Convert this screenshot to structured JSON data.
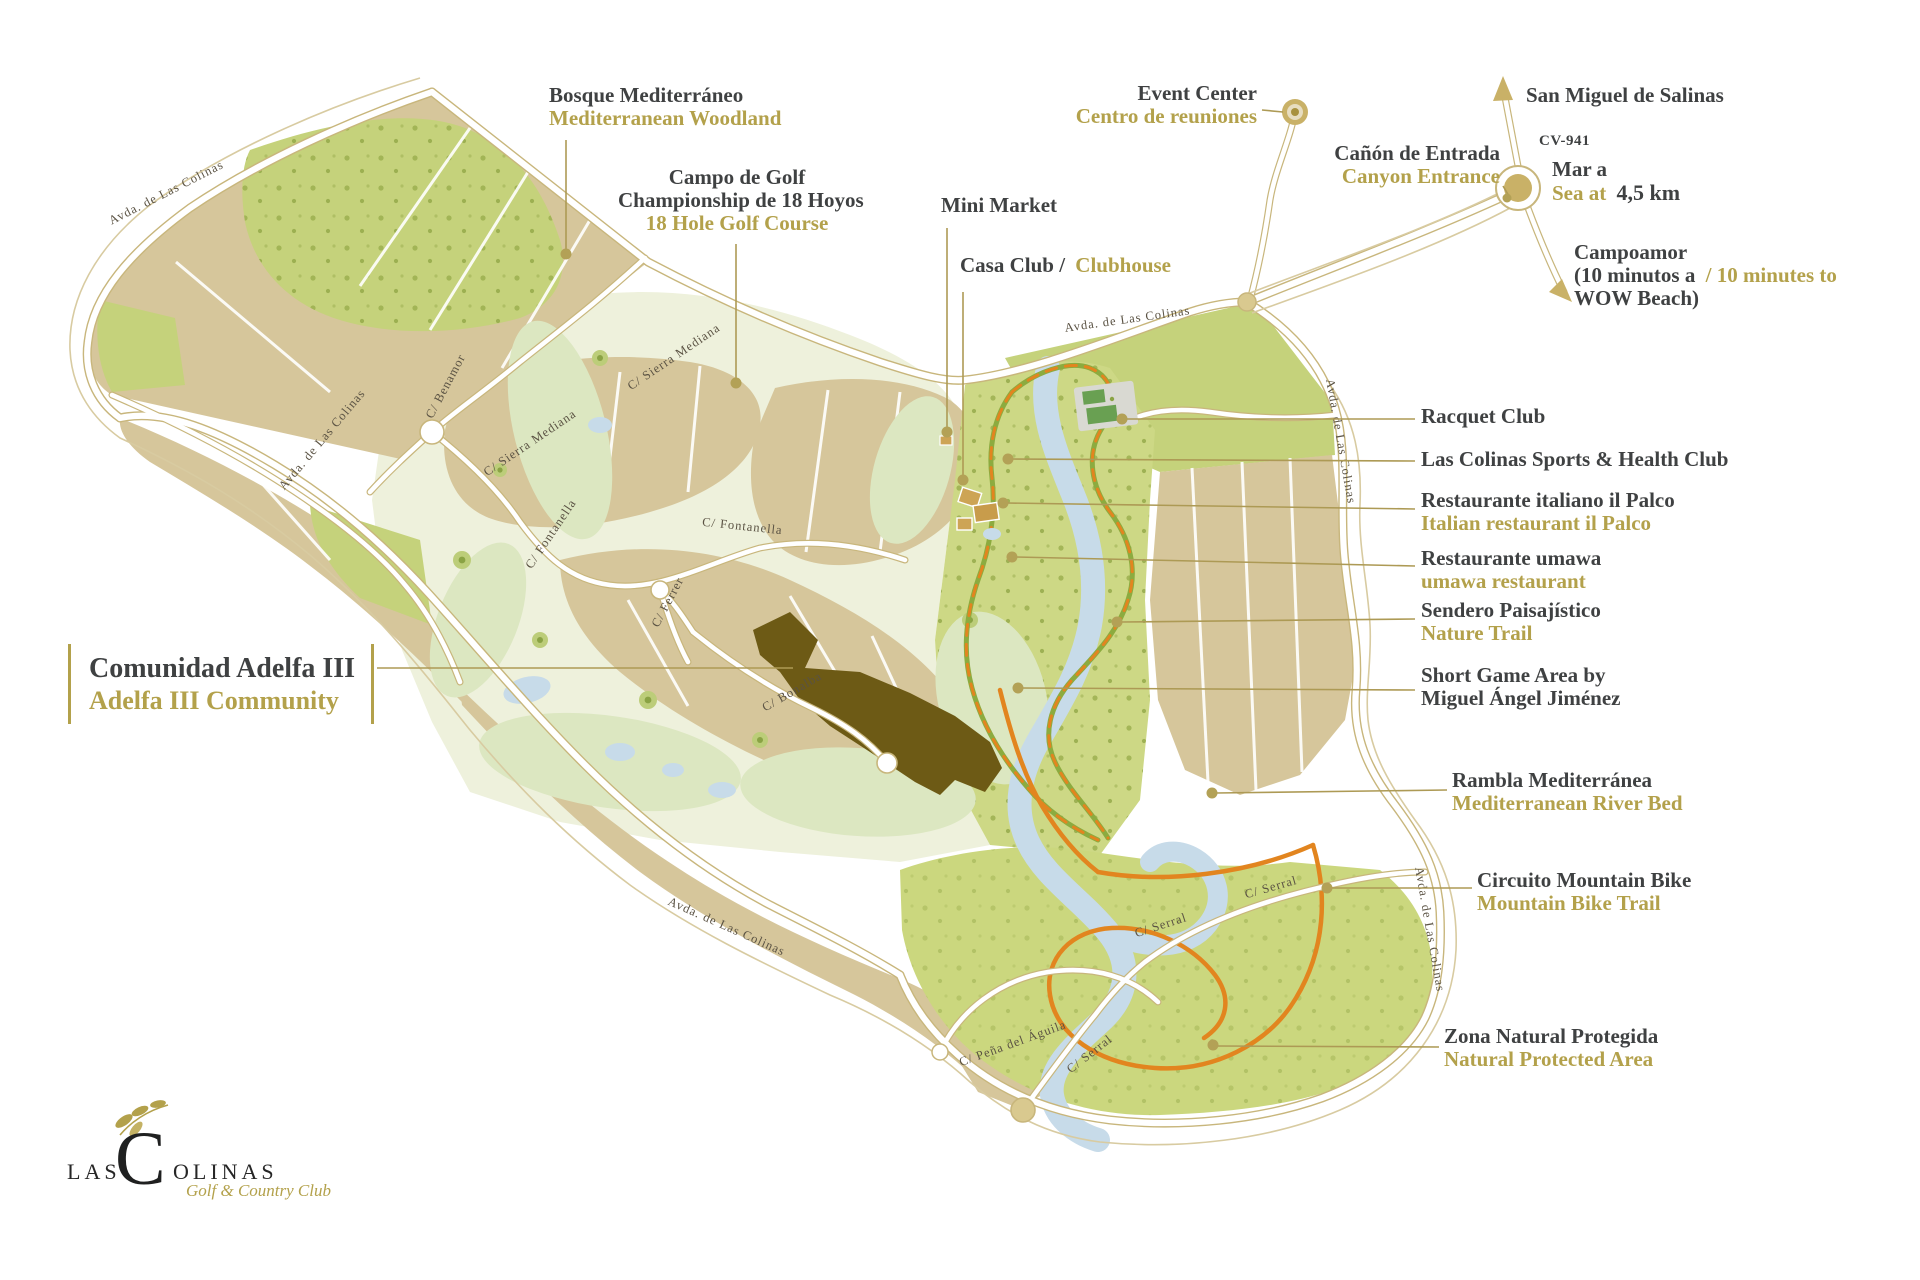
{
  "colors": {
    "ink": "#3f4142",
    "gold_text": "#b3a14b",
    "road_gold": "#c8b67c",
    "parcel_tan": "#d6c69b",
    "parcel_green": "#c5d27b",
    "corridor_green": "#cdd885",
    "golf_pale": "#eef1dc",
    "river_blue": "#c7dbe9",
    "trail_orange": "#e2851f",
    "trail_green": "#8cab3f",
    "adelfa_brown": "#6d5a15"
  },
  "logo": {
    "prefix": "LAS",
    "initial": "C",
    "suffix": "OLINAS",
    "tagline": "Golf & Country Club",
    "branch_icon": "olive-branch"
  },
  "featured": {
    "primary": "Comunidad Adelfa III",
    "secondary": "Adelfa III Community"
  },
  "callouts": {
    "bosque": {
      "primary": "Bosque Mediterráneo",
      "secondary": "Mediterranean Woodland"
    },
    "campo": {
      "line1": "Campo de Golf",
      "line2": "Championship de 18 Hoyos",
      "secondary": "18 Hole Golf Course"
    },
    "mini_market": {
      "primary": "Mini Market"
    },
    "casa_club": {
      "primary": "Casa Club /",
      "secondary": "Clubhouse"
    },
    "event_center": {
      "primary": "Event Center",
      "secondary": "Centro de reuniones"
    },
    "canyon": {
      "primary": "Cañón de Entrada",
      "secondary": "Canyon Entrance"
    },
    "san_miguel": {
      "primary": "San Miguel de Salinas"
    },
    "road_ref": {
      "primary": "CV-941"
    },
    "sea": {
      "primary": "Mar a",
      "secondary": "Sea at",
      "distance": "4,5 km"
    },
    "campoamor": {
      "line1": "Campoamor",
      "line2_dark": "(10 minutos a",
      "line2_gold": "/ 10 minutes to",
      "line3": "WOW Beach)"
    },
    "racquet": {
      "primary": "Racquet Club"
    },
    "sports_club": {
      "primary": "Las Colinas Sports & Health Club"
    },
    "il_palco": {
      "primary": "Restaurante italiano il Palco",
      "secondary": "Italian restaurant il Palco"
    },
    "umawa": {
      "primary": "Restaurante umawa",
      "secondary": "umawa restaurant"
    },
    "sendero": {
      "primary": "Sendero Paisajístico",
      "secondary": "Nature Trail"
    },
    "short_game": {
      "line1": "Short Game Area by",
      "line2": "Miguel Ángel Jiménez"
    },
    "rambla": {
      "primary": "Rambla Mediterránea",
      "secondary": "Mediterranean River Bed"
    },
    "mtb": {
      "primary": "Circuito Mountain Bike",
      "secondary": "Mountain Bike Trail"
    },
    "zona": {
      "primary": "Zona Natural Protegida",
      "secondary": "Natural Protected Area"
    }
  },
  "streets": [
    {
      "name": "Avda. de Las Colinas"
    },
    {
      "name": "Avda. de Las Colinas"
    },
    {
      "name": "Avda. de Las Colinas"
    },
    {
      "name": "Avda. de Las Colinas"
    },
    {
      "name": "Avda. de Las Colinas"
    },
    {
      "name": "Avda. de Las Colinas"
    },
    {
      "name": "C/ Sierra Mediana"
    },
    {
      "name": "C/ Sierra Mediana"
    },
    {
      "name": "C/ Fontanella"
    },
    {
      "name": "C/ Fontanella"
    },
    {
      "name": "C/ Ferrer"
    },
    {
      "name": "C/ Bonalba"
    },
    {
      "name": "C/ Benamor"
    },
    {
      "name": "C/ Serral"
    },
    {
      "name": "C/ Serral"
    },
    {
      "name": "C/ Serral"
    },
    {
      "name": "C/ Peña del Águila"
    }
  ]
}
